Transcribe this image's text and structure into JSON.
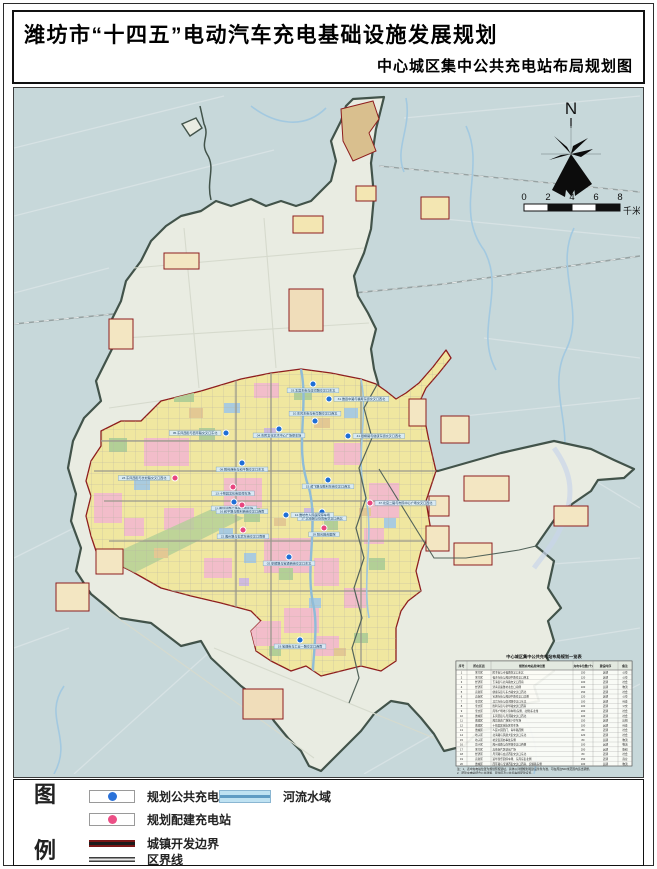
{
  "page": {
    "title": "潍坊市“十四五”电动汽车充电基础设施发展规划",
    "subtitle": "中心城区集中公共充电站布局规划图"
  },
  "compass": {
    "north_label": "N"
  },
  "scale_bar": {
    "ticks": [
      "0",
      "2",
      "4",
      "6",
      "8"
    ],
    "unit": "千米"
  },
  "legend": {
    "heading_top": "图",
    "heading_bottom": "例",
    "items": [
      {
        "label": "规划公共充电站",
        "type": "public-station",
        "color": "#2b72d9"
      },
      {
        "label": "规划配建充电站",
        "type": "built-in-station",
        "color": "#ec4f86"
      },
      {
        "label": "城镇开发边界",
        "type": "urban-boundary",
        "color": "#7a1616"
      },
      {
        "label": "区界线",
        "type": "district-line",
        "color": "#3d3d3d"
      }
    ],
    "water_label": "河流水域",
    "water_color": "#bfe2f2"
  },
  "map": {
    "station_colors": {
      "public": "#1e6ed6",
      "builtin": "#e8457f"
    },
    "stations": [
      {
        "id": "33",
        "type": "public",
        "x": 299,
        "y": 296,
        "side": "below",
        "label": "33.北宫东街与虞河路交叉口东北"
      },
      {
        "id": "31",
        "type": "public",
        "x": 315,
        "y": 311,
        "side": "right",
        "label": "31.潍县中路与福寿东街交叉口西北"
      },
      {
        "id": "10",
        "type": "public",
        "x": 301,
        "y": 333,
        "side": "above",
        "label": "10.东风东街与新华路交叉口西北"
      },
      {
        "id": "04",
        "type": "public",
        "x": 265,
        "y": 341,
        "side": "below",
        "label": "04.市民文化艺术中心广场停车场"
      },
      {
        "id": "41",
        "type": "public",
        "x": 334,
        "y": 348,
        "side": "right",
        "label": "41.银枫路与健康东街交叉口西北"
      },
      {
        "id": "05",
        "type": "public",
        "x": 212,
        "y": 345,
        "side": "left",
        "label": "05.东风西街与西环路交叉口东北"
      },
      {
        "id": "08",
        "type": "public",
        "x": 228,
        "y": 375,
        "side": "below",
        "label": "08.胜利西街与和平路交叉口东北"
      },
      {
        "id": "15",
        "type": "public",
        "x": 314,
        "y": 392,
        "side": "below",
        "label": "15.鸢飞路与胜利东街交叉口西北"
      },
      {
        "id": "11",
        "type": "public",
        "x": 220,
        "y": 414,
        "side": "below",
        "label": "11.潍坊站南广场地下停车场"
      },
      {
        "id": "17",
        "type": "public",
        "x": 308,
        "y": 424,
        "side": "below",
        "label": "17.北海路与仓南街交叉口西北"
      },
      {
        "id": "14",
        "type": "public",
        "x": 272,
        "y": 427,
        "side": "right",
        "label": "14.潍坊市人民医院停车场"
      },
      {
        "id": "02",
        "type": "public",
        "x": 275,
        "y": 469,
        "side": "below",
        "label": "02.安顺路与宝通西街交叉口东北"
      },
      {
        "id": "19",
        "type": "public",
        "x": 286,
        "y": 552,
        "side": "below",
        "label": "19.宝通街与工业一路交叉口西南"
      },
      {
        "id": "23",
        "type": "builtin",
        "x": 161,
        "y": 390,
        "side": "left",
        "label": "23.东风西街与长松路交叉口西北"
      },
      {
        "id": "13",
        "type": "builtin",
        "x": 219,
        "y": 399,
        "side": "below",
        "label": "13.十笏园文化街区停车场"
      },
      {
        "id": "16",
        "type": "builtin",
        "x": 228,
        "y": 417,
        "side": "below",
        "label": "16.和平路与胜利西街交叉口西南"
      },
      {
        "id": "37",
        "type": "builtin",
        "x": 356,
        "y": 415,
        "side": "right",
        "label": "37.北宫二路与市民中心广场交叉口西北"
      },
      {
        "id": "39",
        "type": "builtin",
        "x": 310,
        "y": 440,
        "side": "below",
        "label": "39.阳光融合医院"
      },
      {
        "id": "22",
        "type": "builtin",
        "x": 229,
        "y": 442,
        "side": "below",
        "label": "22.潍州路与玄武东街交叉口南侧"
      }
    ],
    "table": {
      "title": "中心城区集中公共充电站布局规划一览表",
      "headers": [
        "序号",
        "所在区县",
        "规划充电站具体位置",
        "充电车位数(个)",
        "建设时序",
        "备注"
      ],
      "rows": [
        [
          "1",
          "寒亭区",
          "民主街与幸福路交叉口东北",
          "150",
          "近期",
          "公交"
        ],
        [
          "2",
          "寒亭区",
          "福寿东街与潍县中路交叉口西北",
          "120",
          "近期",
          "公交"
        ],
        [
          "3",
          "经济区",
          "玉清街与北海路交叉口西南",
          "100",
          "近期",
          "社会"
        ],
        [
          "4",
          "经济区",
          "济青高速潍坊北出口南侧",
          "100",
          "远期",
          "物流"
        ],
        [
          "5",
          "高新区",
          "健康东街与东方路交叉口西北",
          "150",
          "近期",
          "社会"
        ],
        [
          "6",
          "高新区",
          "宝通东街与潍县中路交叉口北侧",
          "120",
          "近期",
          "公交"
        ],
        [
          "7",
          "奎文区",
          "北宫东街与虞河路交叉口东北",
          "100",
          "近期",
          "社会"
        ],
        [
          "8",
          "奎文区",
          "胜利东街与新华路交叉口西南",
          "100",
          "近期",
          "公交"
        ],
        [
          "9",
          "奎文区",
          "风筝广场地下停车场(东侧、北侧)东北角",
          "200",
          "近期",
          "社会"
        ],
        [
          "10",
          "潍城区",
          "东风西街与月河路交叉口西北",
          "100",
          "近期",
          "社会"
        ],
        [
          "11",
          "潍城区",
          "潍坊站南广场地下停车场",
          "150",
          "近期",
          "出租"
        ],
        [
          "12",
          "潍城区",
          "十笏园文化街区停车场",
          "100",
          "远期",
          "社会"
        ],
        [
          "13",
          "潍城区",
          "人民公园西门、青年路西侧",
          "80",
          "近期",
          "社会"
        ],
        [
          "14",
          "坊子区",
          "北海路与凤凰大街交叉口东北",
          "120",
          "近期",
          "社会"
        ],
        [
          "15",
          "坊子区",
          "坊安街道办事处东侧",
          "80",
          "远期",
          "物流"
        ],
        [
          "16",
          "坊子区",
          "潍州南路与南环路交叉口西侧",
          "100",
          "远期",
          "物流"
        ],
        [
          "17",
          "寒亭区",
          "高铁新片区站前广场",
          "200",
          "远期",
          "枢纽"
        ],
        [
          "18",
          "经济区",
          "月河路与玄武西街交叉口东北",
          "80",
          "近期",
          "社会"
        ],
        [
          "19",
          "高新区",
          "富华游乐园停车场、东风东街北侧",
          "150",
          "近期",
          "商业"
        ],
        [
          "20",
          "潍城区",
          "西环路与宝通西街交叉口西南、安顺路东侧",
          "100",
          "远期",
          "物流"
        ]
      ],
      "notes": [
        "注：1、表中充电站位置为规划预留选址，具体以详细规划和建设条件为准，可在周边500米范围内适当调整。",
        "2、配建充电站结合公共建筑、居住区及公共停车场配建设置。"
      ]
    }
  }
}
